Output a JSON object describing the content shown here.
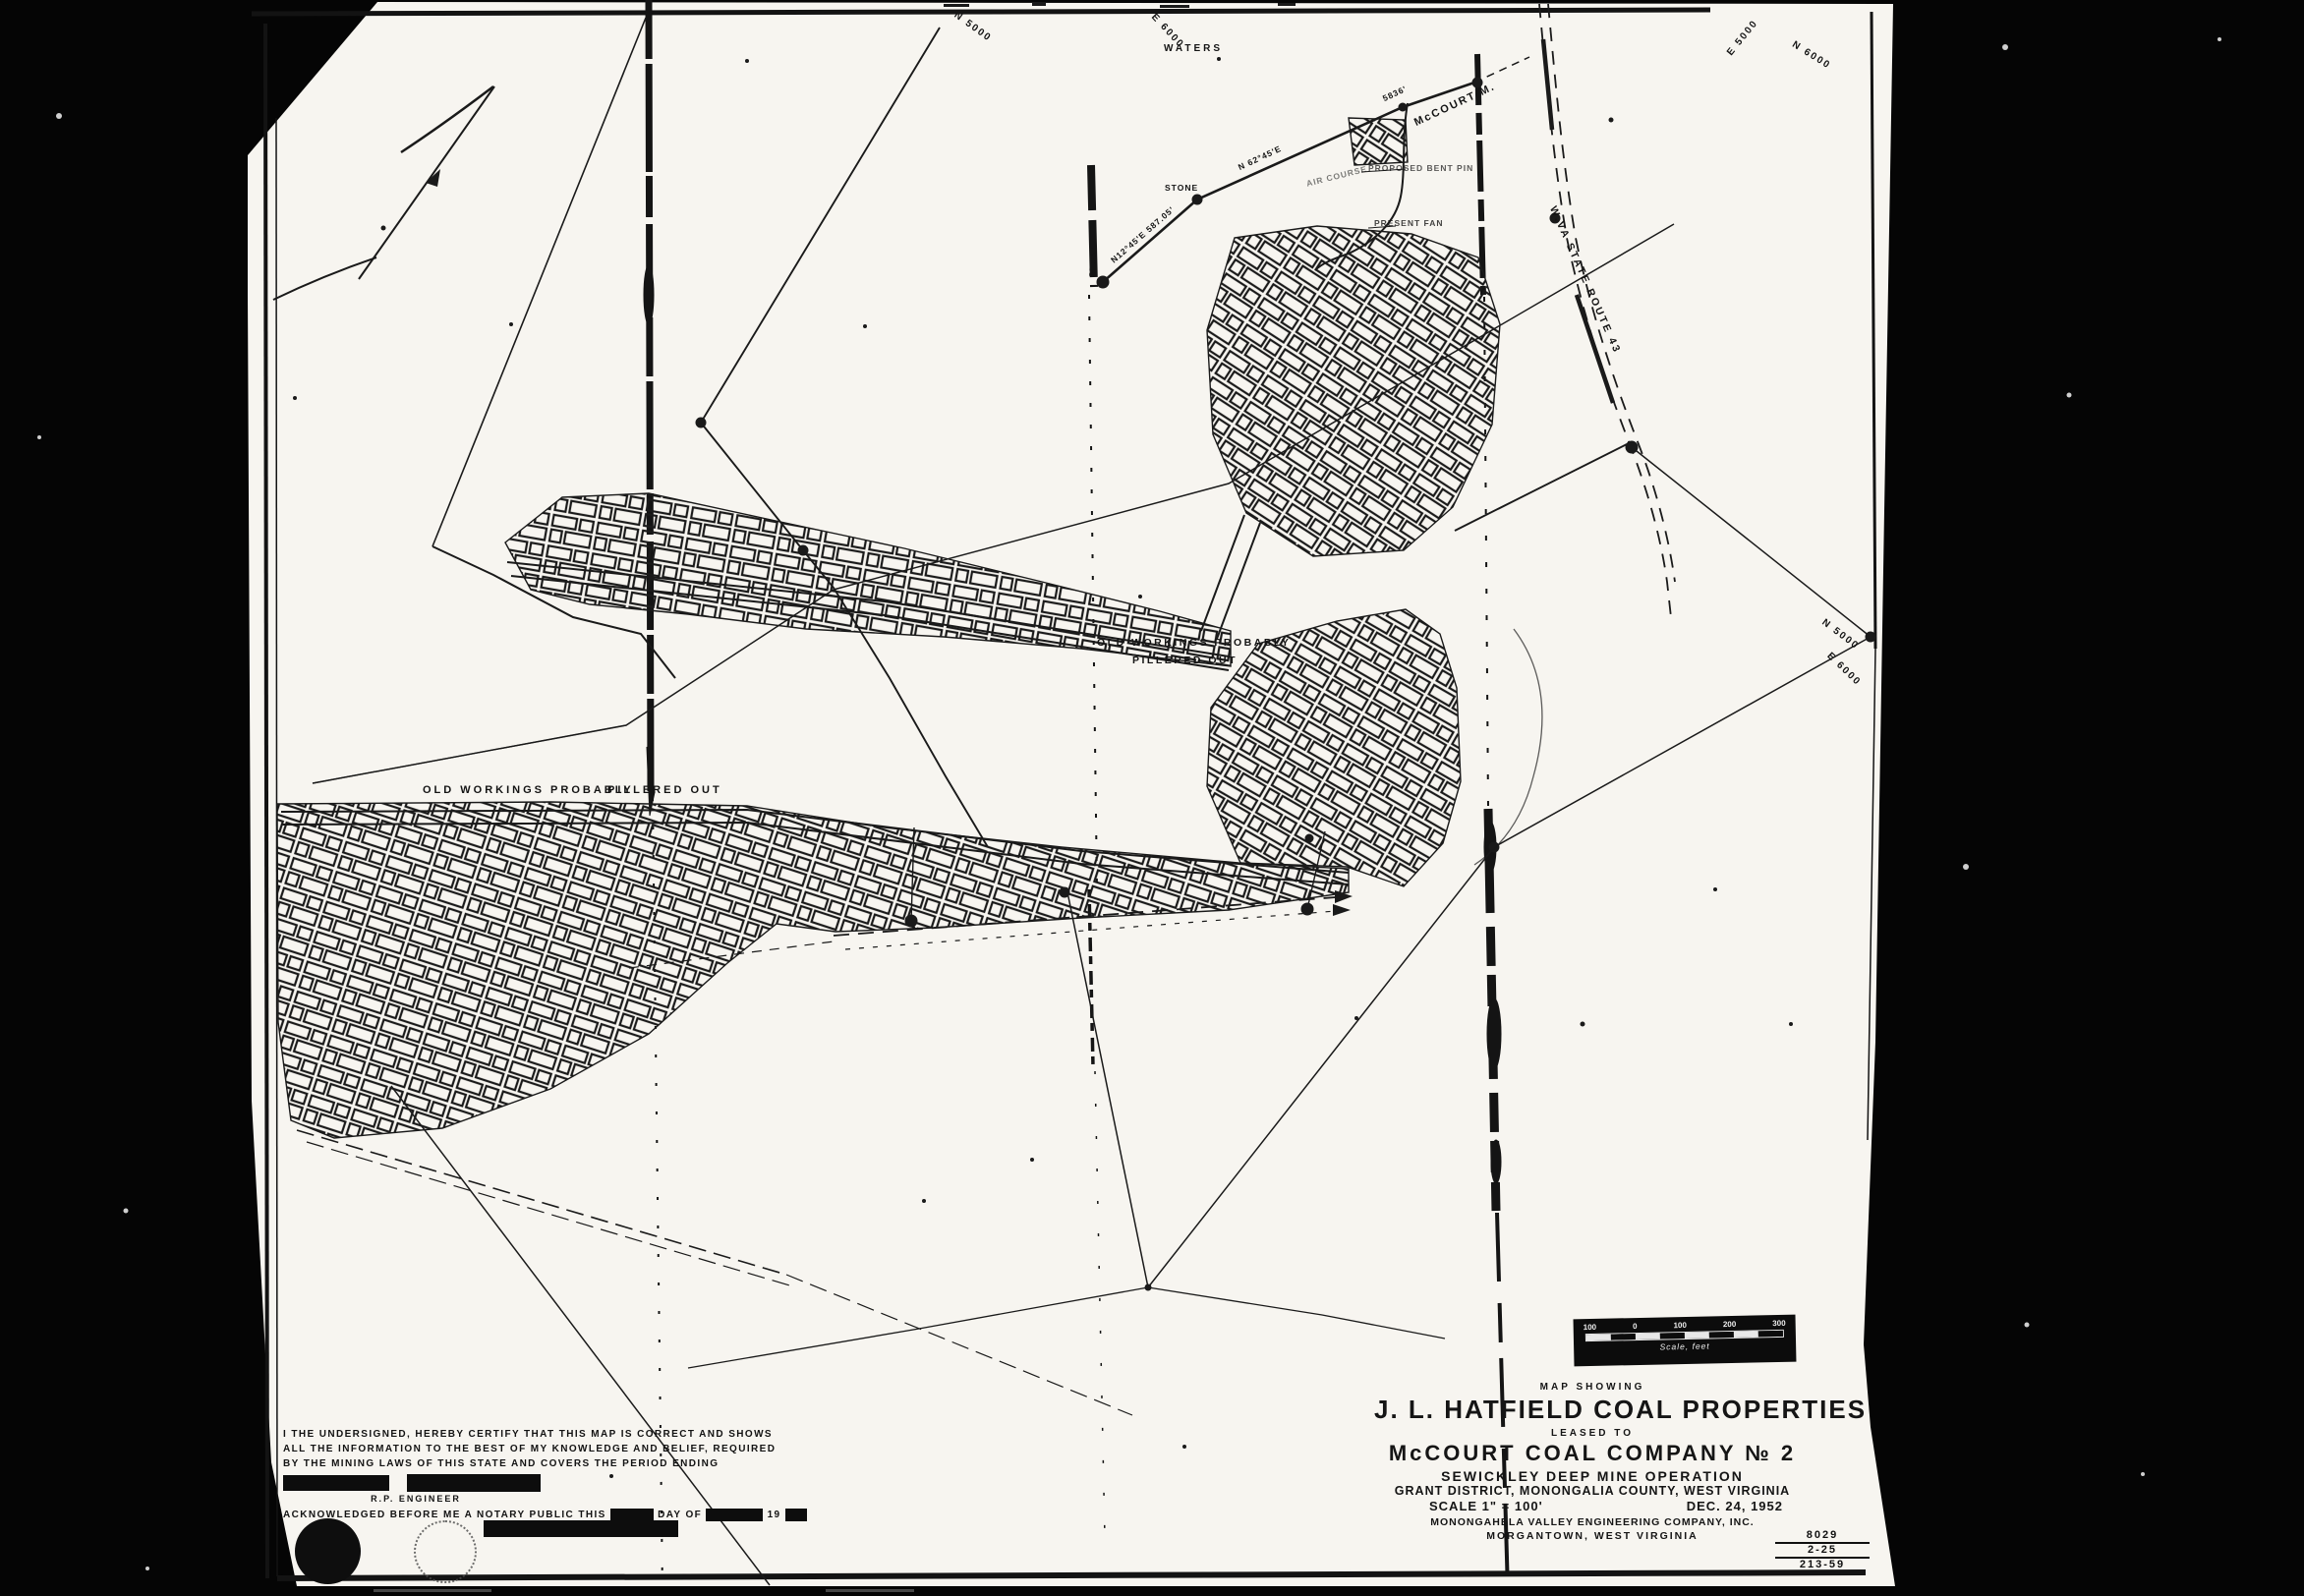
{
  "map_labels": {
    "grid_n5000_top": "N 5000",
    "grid_e6000_top": "E 6000",
    "waters": "WATERS",
    "grid_e5000_topright": "E 5000",
    "grid_n6000_topright": "N 6000",
    "grid_n5000_right": "N 5000",
    "grid_e6000_right": "E 6000",
    "stone_vertical": "STONE",
    "stone_horizontal": "STONE",
    "bearing_leg1": "N12°45'E  587.05'",
    "bearing_leg2": "N 62°45'E",
    "distance_leg2": "5836'",
    "mccourt_mine": "McCOURT M.",
    "air_course": "AIR COURSE",
    "proposed_pin": "PROPOSED BENT PIN",
    "present_fan": "PRESENT FAN",
    "route43": "W.VA STATE ROUTE 43",
    "old_workings_left_1": "OLD WORKINGS PROBABLY",
    "old_workings_left_2": "PILLERED OUT",
    "old_workings_center_1": "OLD WORKINGS PROBABLY",
    "old_workings_center_2": "PILLERED OUT"
  },
  "title_block": {
    "eyebrow": "MAP SHOWING",
    "title": "J. L. HATFIELD COAL PROPERTIES",
    "leased_to": "LEASED TO",
    "company": "McCOURT COAL COMPANY № 2",
    "operation": "SEWICKLEY DEEP MINE OPERATION",
    "location": "GRANT DISTRICT, MONONGALIA COUNTY, WEST VIRGINIA",
    "scale": "SCALE  1\" = 100'",
    "date": "DEC. 24, 1952",
    "firm": "MONONGAHELA VALLEY ENGINEERING COMPANY, INC.",
    "city": "MORGANTOWN, WEST VIRGINIA"
  },
  "corner_numbers": {
    "n1": "8029",
    "n2": "2-25",
    "n3": "213-59"
  },
  "scale_bar": {
    "ticks": [
      "100",
      "0",
      "100",
      "200",
      "300"
    ],
    "caption": "Scale, feet"
  },
  "certification": {
    "line1": "I THE UNDERSIGNED, HEREBY CERTIFY THAT THIS MAP IS CORRECT AND SHOWS",
    "line2": "ALL THE INFORMATION TO THE BEST OF MY KNOWLEDGE AND BELIEF, REQUIRED",
    "line3": "BY THE MINING LAWS OF THIS STATE AND COVERS THE PERIOD ENDING",
    "engineer": "R.P. ENGINEER",
    "notary_pre": "ACKNOWLEDGED BEFORE ME A NOTARY PUBLIC THIS",
    "notary_mid": "DAY OF",
    "notary_year": "19"
  },
  "colors": {
    "paper": "#f7f5f0",
    "ink": "#1a1a1a",
    "background": "#050505"
  }
}
